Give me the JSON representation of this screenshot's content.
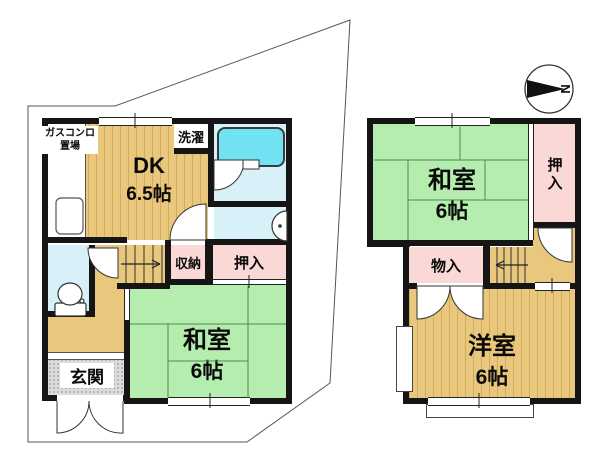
{
  "floorplan": {
    "floor1": {
      "gas_line1": "ガスコンロ",
      "gas_line2": "置場",
      "laundry": "洗濯",
      "dk": "DK",
      "dk_size": "6.5帖",
      "storage": "収納",
      "closet": "押入",
      "tatami": "和室",
      "tatami_size": "6帖",
      "entrance": "玄関"
    },
    "floor2": {
      "tatami": "和室",
      "tatami_size": "6帖",
      "closet": "押入",
      "storage": "物入",
      "western": "洋室",
      "western_size": "6帖"
    },
    "compass": {
      "north": "N"
    },
    "colors": {
      "wall_black": "#151515",
      "wood_tan": "#e9c87e",
      "tatami_green": "#b4edae",
      "closet_pink": "#f9d8d6",
      "bath_cyan": "#d8f1f8",
      "bathtub_cyan": "#70e2f2",
      "entrance_gray": "#dcdcdc"
    }
  }
}
